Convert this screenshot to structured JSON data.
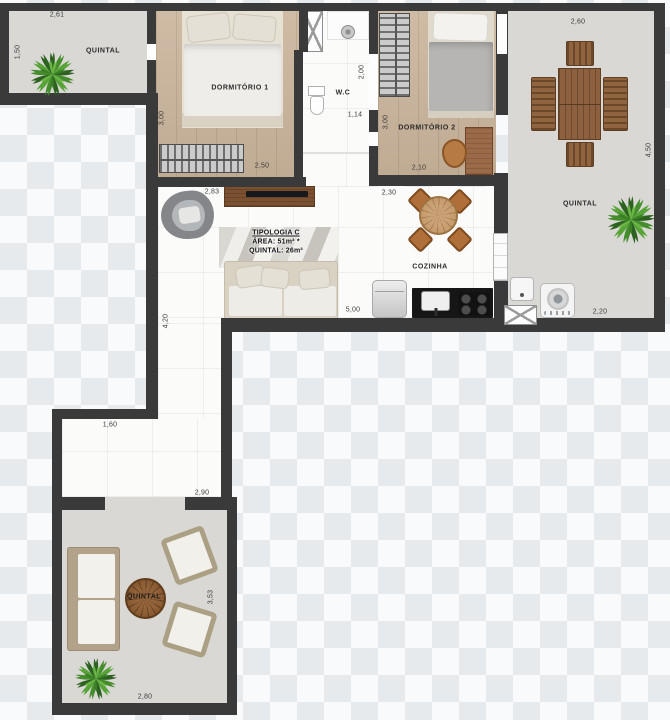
{
  "plan": {
    "tipologia": {
      "line1": "TIPOLOGIA C",
      "line2": "ÁREA: 51m² *",
      "line3": "QUINTAL: 26m²"
    },
    "labels": {
      "quintal": "QUINTAL",
      "dorm1": "DORMITÓRIO 1",
      "dorm2": "DORMITÓRIO 2",
      "wc": "W.C",
      "cozinha": "COZINHA"
    },
    "dims": {
      "q_tl_top": "2,61",
      "q_tl_left": "1,50",
      "dorm1_left": "3,00",
      "dorm1_bottom": "2,50",
      "wc_right": "2,00",
      "wc_bottom": "1,14",
      "dorm2_left": "3,00",
      "dorm2_bottom": "2,10",
      "q_r_top": "2,60",
      "q_r_right": "4,50",
      "q_r_bottom": "2,20",
      "living_top": "2,83",
      "living_left": "4,20",
      "cozinha_top": "2,30",
      "cozinha_bottom": "5,00",
      "hall_top": "1,60",
      "hall_bottom": "2,90",
      "q_b_right": "3,53",
      "q_b_bottom": "2,80"
    },
    "colors": {
      "wall": "#3a3a3a",
      "quintal_floor": "#d9d8d4",
      "wood_floor": "#cab49b",
      "plant_green": "#3b7d27"
    }
  }
}
